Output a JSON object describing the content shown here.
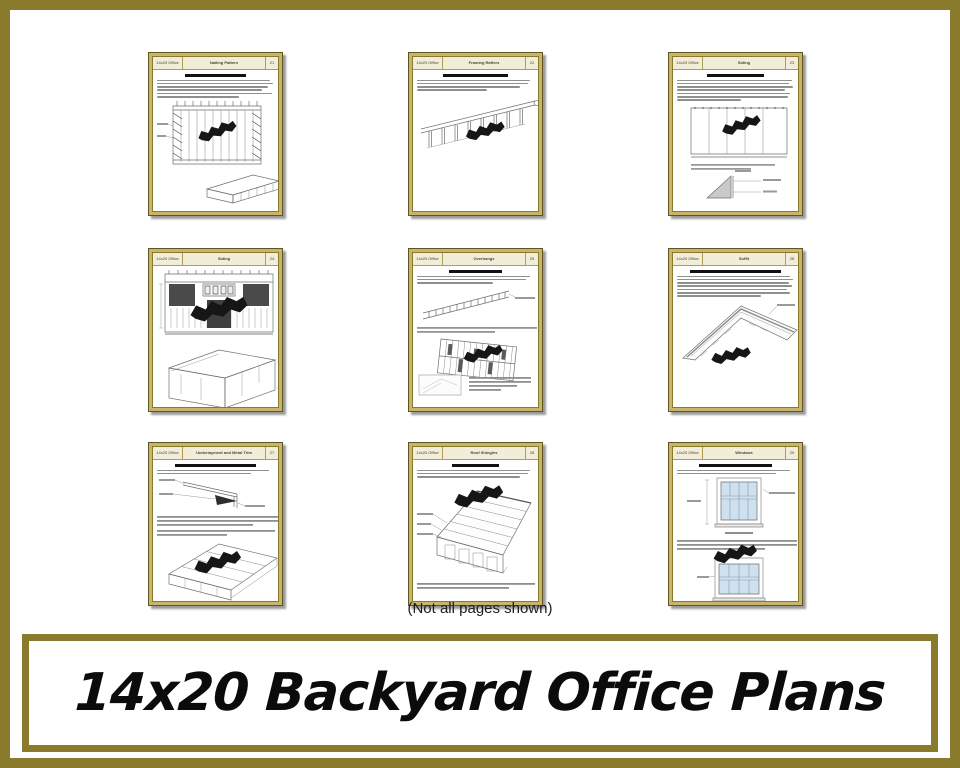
{
  "caption": "(Not all pages shown)",
  "banner": {
    "title": "14x20 Backyard Office Plans"
  },
  "colors": {
    "border_gold": "#8A7B2C",
    "page_frame_tan": "#C9B569",
    "header_cream": "#F2EDD8",
    "window_glass_blue": "#CFE0EE",
    "watermark_black": "#161616"
  },
  "pages": [
    {
      "brand": "14x20 Office",
      "title": "Nailing Pattern",
      "page_no": "21"
    },
    {
      "brand": "14x20 Office",
      "title": "Framing Rafters",
      "page_no": "22"
    },
    {
      "brand": "14x20 Office",
      "title": "Siding",
      "page_no": "23"
    },
    {
      "brand": "14x20 Office",
      "title": "Siding",
      "page_no": "24"
    },
    {
      "brand": "14x20 Office",
      "title": "Overhangs",
      "page_no": "25"
    },
    {
      "brand": "14x20 Office",
      "title": "Soffit",
      "page_no": "26"
    },
    {
      "brand": "14x20 Office",
      "title": "Underlayment and Metal Trim",
      "page_no": "27"
    },
    {
      "brand": "14x20 Office",
      "title": "Roof Shingles",
      "page_no": "28"
    },
    {
      "brand": "14x20 Office",
      "title": "Windows",
      "page_no": "29"
    }
  ]
}
